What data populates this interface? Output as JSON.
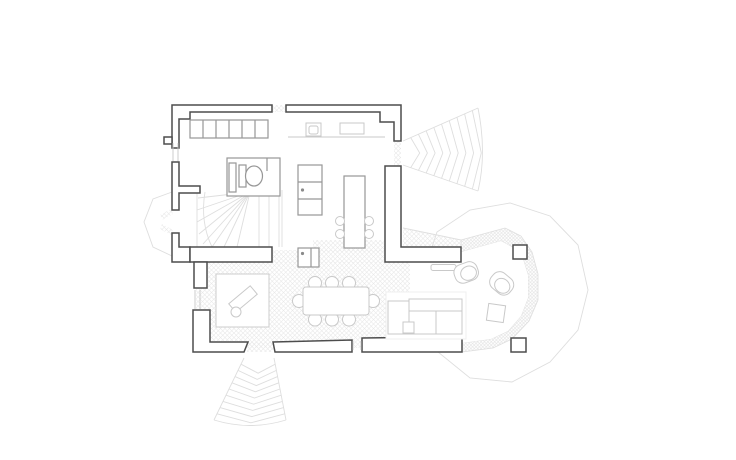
{
  "drawing": {
    "kind": "architectural-floor-plan",
    "elements": [
      "exterior-walls",
      "built-in-wardrobe",
      "wc-room",
      "toilet",
      "winder-staircase",
      "bay-window",
      "kitchen-counter",
      "kitchen-sink",
      "cooktop",
      "tall-cabinet",
      "appliance-cabinet",
      "kitchen-island",
      "island-stools",
      "dining-table",
      "dining-chairs",
      "rug",
      "chaise",
      "sectional-sofa",
      "sofa-side-table",
      "armchair",
      "armchair",
      "conservatory-side-table",
      "console-table",
      "conservatory",
      "glazing-band",
      "column",
      "column",
      "exterior-fan-steps-east",
      "exterior-fan-steps-south",
      "floor-hatching"
    ]
  },
  "colors": {
    "background": "#ffffff",
    "wall": "#4d4d4d",
    "fixture": "#979797",
    "furniture": "#c9c9c9",
    "faint": "#dedede",
    "hatch": "#e8e8e8",
    "hatch_dense": "#e1e1e1"
  }
}
